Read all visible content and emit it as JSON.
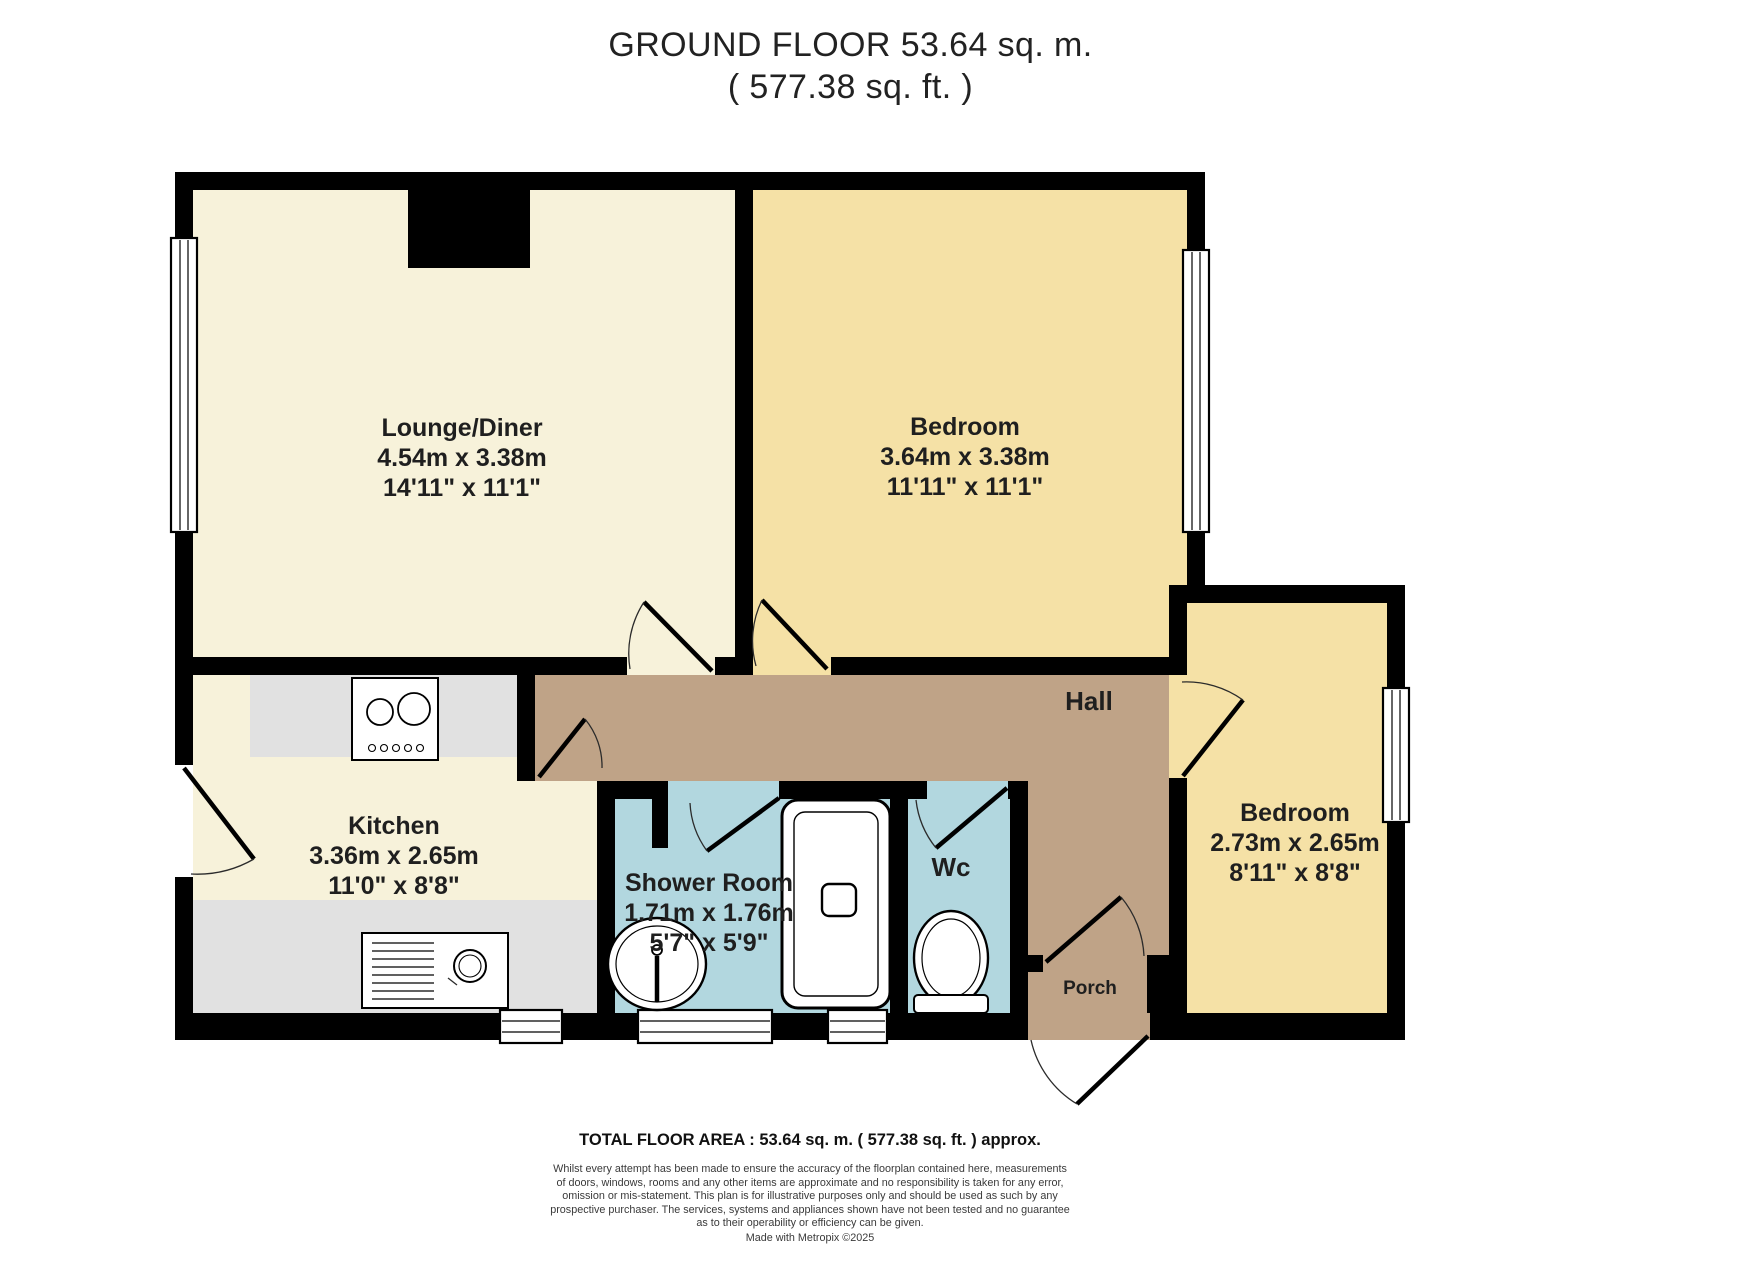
{
  "title": {
    "line1": "GROUND FLOOR 53.64 sq. m.",
    "line2": "( 577.38 sq. ft. )"
  },
  "rooms": {
    "lounge": {
      "name": "Lounge/Diner",
      "metric": "4.54m x 3.38m",
      "imperial": "14'11\" x 11'1\""
    },
    "bedroom1": {
      "name": "Bedroom",
      "metric": "3.64m x 3.38m",
      "imperial": "11'11\" x 11'1\""
    },
    "kitchen": {
      "name": "Kitchen",
      "metric": "3.36m x 2.65m",
      "imperial": "11'0\" x 8'8\""
    },
    "shower_room": {
      "name": "Shower Room",
      "metric": "1.71m x 1.76m",
      "imperial": "5'7\" x 5'9\""
    },
    "wc": {
      "name": "Wc"
    },
    "hall": {
      "name": "Hall"
    },
    "porch": {
      "name": "Porch"
    },
    "bedroom2": {
      "name": "Bedroom",
      "metric": "2.73m x 2.65m",
      "imperial": "8'11\" x 8'8\""
    }
  },
  "footer": {
    "total": "TOTAL FLOOR AREA : 53.64 sq. m. ( 577.38 sq. ft. ) approx.",
    "disclaimer_lines": [
      "Whilst every attempt has been made to ensure the accuracy of the floorplan contained here, measurements",
      "of doors, windows, rooms and any other items are approximate and no responsibility is taken for any error,",
      "omission or mis-statement. This plan is for illustrative purposes only and should be used as such by any",
      "prospective purchaser. The services, systems and appliances shown have not been tested and no guarantee",
      "as to their operability or efficiency can be given."
    ],
    "credit": "Made with Metropix ©2025"
  },
  "colors": {
    "walls": "#000000",
    "lounge_floor": "#f7f2da",
    "bedroom_floor": "#f5e1a6",
    "hall_floor": "#bfa387",
    "wet_room_floor": "#b2d7df",
    "counter": "#e1e1e1",
    "fixture": "#ffffff",
    "text": "#1f1f1f"
  }
}
